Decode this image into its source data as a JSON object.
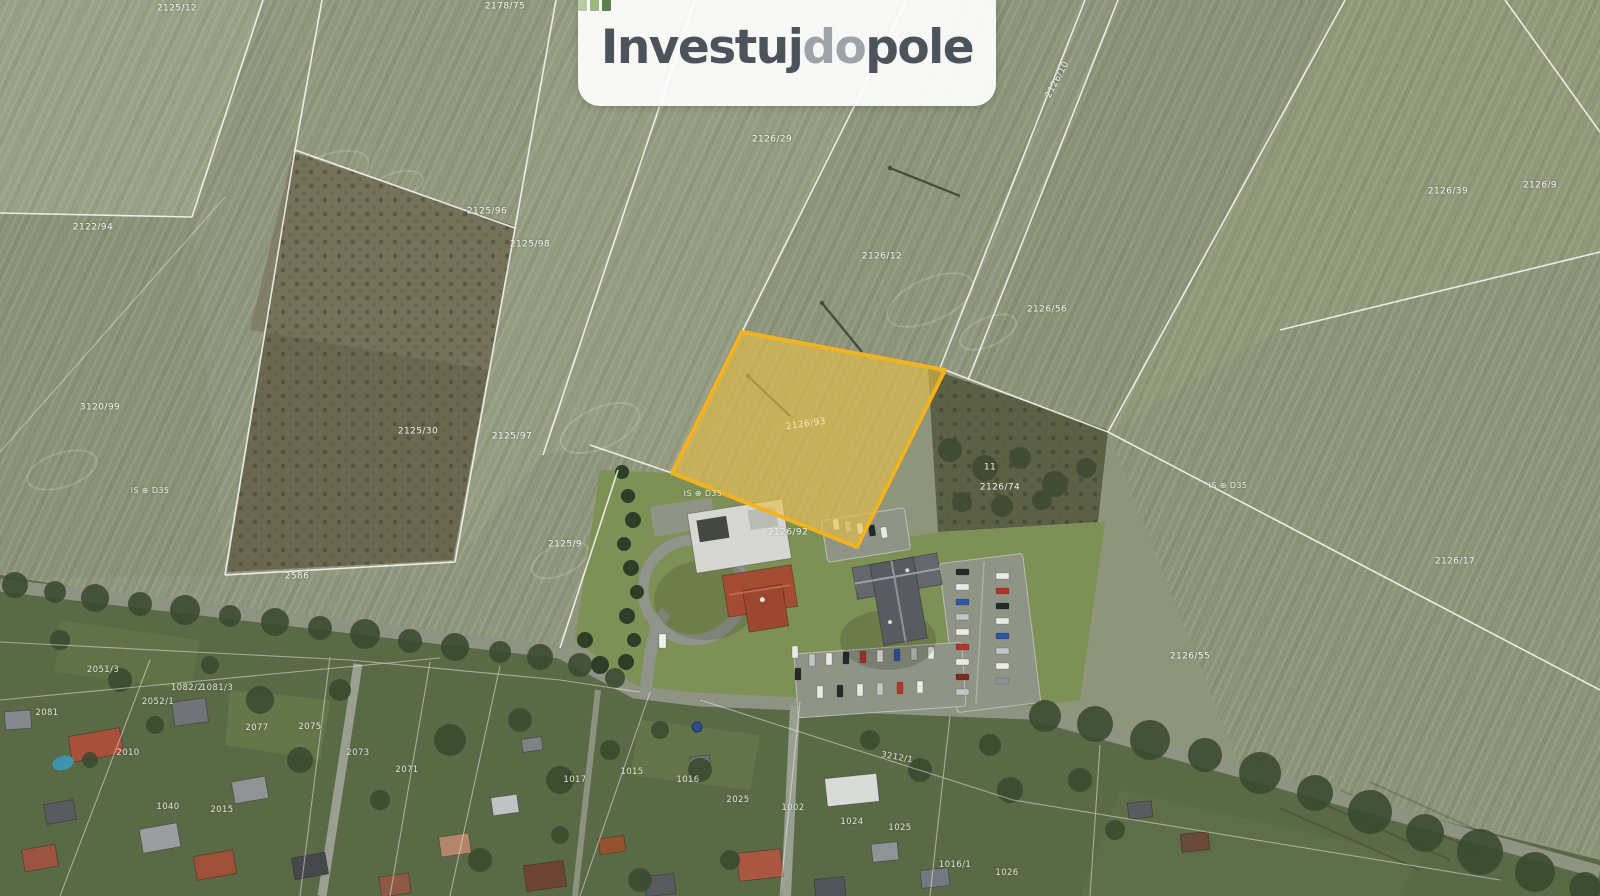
{
  "brand": "Investujdopole",
  "logo": {
    "icon": "bar-chart-icon",
    "part1": "Investuj",
    "part2": "do",
    "part3": "pole",
    "bar_colors": [
      "#b9cba3",
      "#9cb782",
      "#5e7e4b"
    ],
    "text_color": "#4d535a",
    "light_text_color": "#9da3a9"
  },
  "map": {
    "type": "satellite-cadastral",
    "palette": {
      "field_base": "#8f957c",
      "village_green": "#5a6a46",
      "scrub_brown": "#655f46",
      "boundary_line": "#ffffff"
    },
    "highlight": {
      "fill": "#e9c044",
      "fill_opacity": "0.62",
      "stroke": "#f2b320"
    },
    "highlight_label": {
      "text": "2126/93",
      "x": 806,
      "y": 425,
      "rot": -8
    },
    "field_labels": [
      {
        "text": "2125/12",
        "x": 177,
        "y": 9
      },
      {
        "text": "2178/75",
        "x": 505,
        "y": 7
      },
      {
        "text": "2126/29",
        "x": 772,
        "y": 140
      },
      {
        "text": "2126/12",
        "x": 882,
        "y": 257
      },
      {
        "text": "2126/56",
        "x": 1047,
        "y": 310
      },
      {
        "text": "2126/10",
        "x": 1058,
        "y": 80,
        "rot": -62
      },
      {
        "text": "2126/39",
        "x": 1448,
        "y": 192
      },
      {
        "text": "2126/9",
        "x": 1540,
        "y": 186
      },
      {
        "text": "2122/94",
        "x": 93,
        "y": 228
      },
      {
        "text": "2125/96",
        "x": 487,
        "y": 212
      },
      {
        "text": "2125/98",
        "x": 530,
        "y": 245
      },
      {
        "text": "3120/99",
        "x": 100,
        "y": 408
      },
      {
        "text": "2125/30",
        "x": 418,
        "y": 432
      },
      {
        "text": "2125/97",
        "x": 512,
        "y": 437
      },
      {
        "text": "2125/9",
        "x": 565,
        "y": 545
      },
      {
        "text": "2586",
        "x": 297,
        "y": 577
      },
      {
        "text": "2126/92",
        "x": 788,
        "y": 533
      },
      {
        "text": "11",
        "x": 990,
        "y": 468
      },
      {
        "text": "2126/74",
        "x": 1000,
        "y": 488
      },
      {
        "text": "2126/55",
        "x": 1190,
        "y": 657
      },
      {
        "text": "2126/17",
        "x": 1455,
        "y": 562
      }
    ],
    "village_labels": [
      {
        "text": "2051/3",
        "x": 103,
        "y": 670
      },
      {
        "text": "2081",
        "x": 47,
        "y": 713
      },
      {
        "text": "2052/1",
        "x": 158,
        "y": 702
      },
      {
        "text": "1082/2",
        "x": 187,
        "y": 688
      },
      {
        "text": "1081/3",
        "x": 217,
        "y": 688
      },
      {
        "text": "2077",
        "x": 257,
        "y": 728
      },
      {
        "text": "2075",
        "x": 310,
        "y": 727
      },
      {
        "text": "2073",
        "x": 358,
        "y": 753
      },
      {
        "text": "2071",
        "x": 407,
        "y": 770
      },
      {
        "text": "2010",
        "x": 128,
        "y": 753
      },
      {
        "text": "1040",
        "x": 168,
        "y": 807
      },
      {
        "text": "2015",
        "x": 222,
        "y": 810
      },
      {
        "text": "3212/1",
        "x": 897,
        "y": 758,
        "rot": 10
      },
      {
        "text": "1017",
        "x": 575,
        "y": 780
      },
      {
        "text": "1015",
        "x": 632,
        "y": 772
      },
      {
        "text": "1016",
        "x": 688,
        "y": 780
      },
      {
        "text": "2025",
        "x": 738,
        "y": 800
      },
      {
        "text": "1002",
        "x": 793,
        "y": 808
      },
      {
        "text": "1024",
        "x": 852,
        "y": 822
      },
      {
        "text": "1025",
        "x": 900,
        "y": 828
      },
      {
        "text": "1016/1",
        "x": 955,
        "y": 865
      },
      {
        "text": "1026",
        "x": 1007,
        "y": 873
      }
    ],
    "utility_markers": [
      {
        "text": "IS ⊕ D35",
        "x": 150,
        "y": 491
      },
      {
        "text": "IS ⊕ D35",
        "x": 703,
        "y": 494
      },
      {
        "text": "IS ⊕ D35",
        "x": 1228,
        "y": 486
      }
    ]
  }
}
